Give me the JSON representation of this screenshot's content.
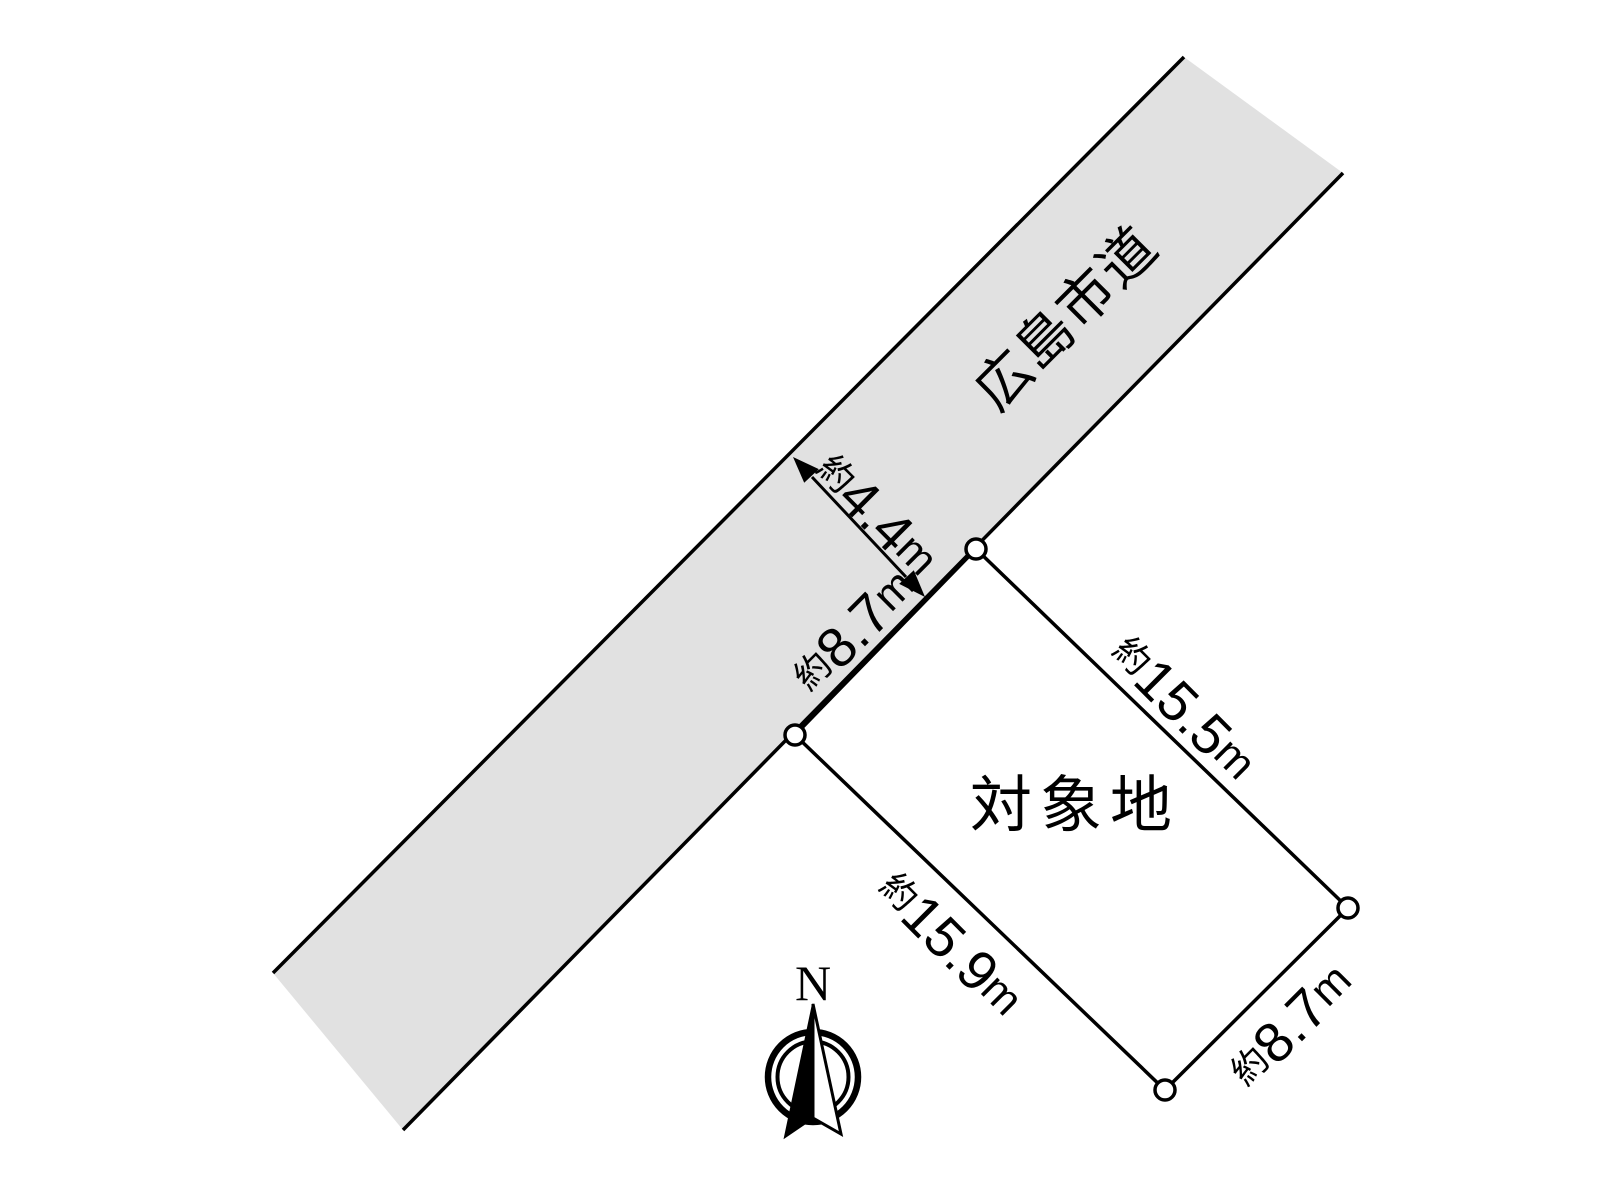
{
  "road": {
    "name": "広島市道",
    "fill": "#e1e1e1",
    "width": {
      "prefix": "約",
      "value": "4.4",
      "unit": "m"
    }
  },
  "site": {
    "name": "対象地",
    "fill": "#e5f0db",
    "frontage": {
      "prefix": "約",
      "value": "8.7",
      "unit": "m"
    },
    "edge_northeast": {
      "prefix": "約",
      "value": "15.5",
      "unit": "m"
    },
    "edge_southwest": {
      "prefix": "約",
      "value": "15.9",
      "unit": "m"
    },
    "edge_southeast": {
      "prefix": "約",
      "value": "8.7",
      "unit": "m"
    }
  },
  "compass": {
    "label": "N"
  },
  "colors": {
    "line": "#000000",
    "vertex_fill": "#ffffff"
  }
}
